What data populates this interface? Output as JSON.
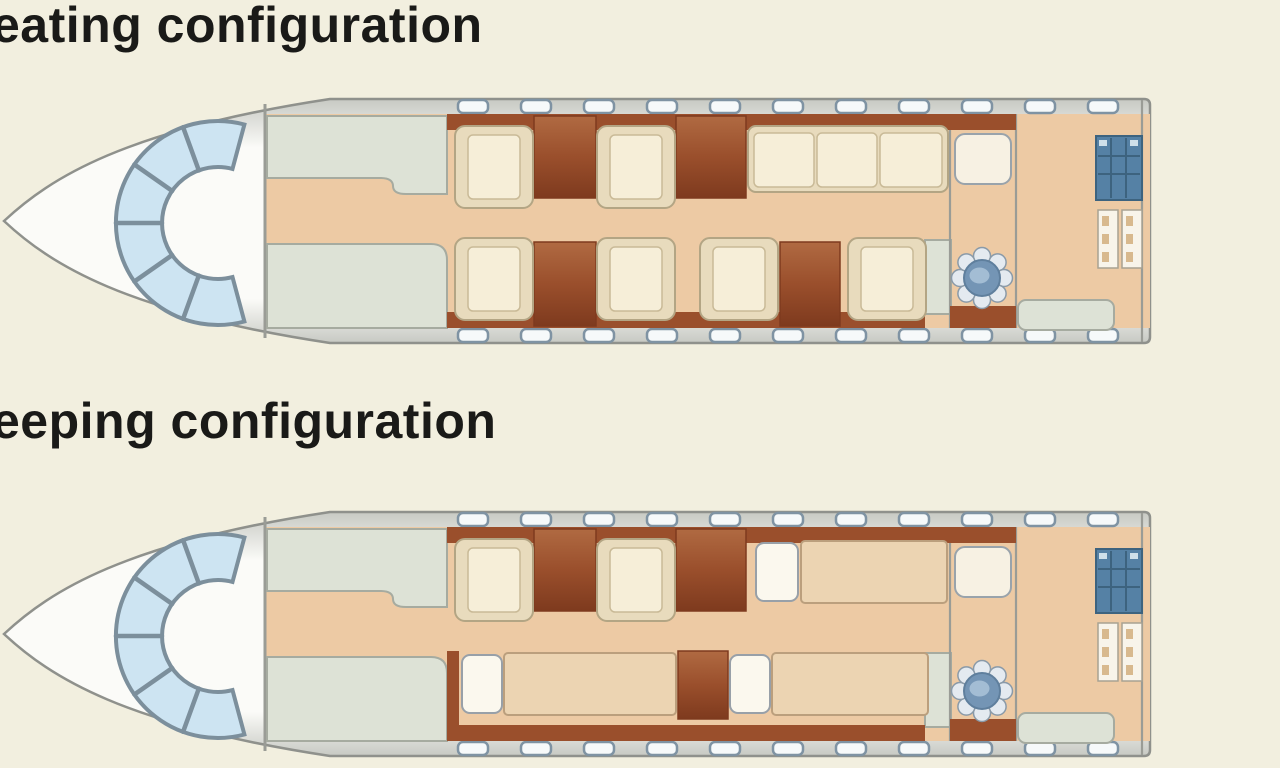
{
  "page": {
    "background": "#f2efdf"
  },
  "titles": {
    "seating": "eating configuration",
    "sleeping": "eeping configuration"
  },
  "palette": {
    "background": "#f2efdf",
    "title": "#1a1a18",
    "outline": "#8f918c",
    "hull-edge": "#c7c9c3",
    "hull-mid": "#fbfbf8",
    "wall": "#9a9c96",
    "glass": "#cde4f2",
    "glass-edge": "#7c8f9c",
    "floor": "#edcaa4",
    "sage": "#dde2d6",
    "sage-edge": "#a6aba0",
    "wood": "#9a4f2c",
    "wood-dark": "#7e3a1e",
    "wood-light": "#b06a42",
    "seat-frame": "#e8dbbd",
    "seat-edge": "#b3a584",
    "cushion": "#f6eed8",
    "cushion-edge": "#c9ba97",
    "window": "#f6f9fa",
    "window-edge": "#7f93a3",
    "vanity": "#f7f1e3",
    "vanity-edge": "#99a3ab",
    "bowl": "#7495b5",
    "bowl-edge": "#5f7f9d",
    "bowl-light": "#a3bdd4",
    "scallop": "#e4eaf0",
    "scallop-edge": "#8a9aa8",
    "teal": "#5581a5",
    "teal-dark": "#3d637f",
    "teal-light": "#cfe0ea",
    "shelf": "#f8f4ea",
    "shelf-edge": "#a8a292",
    "shelf-item": "#d8b98e",
    "mattress": "#ecd4b2",
    "mattress-edge": "#bb9f7d",
    "pillow": "#fbf8ee",
    "pillow-edge": "#98a0a8"
  },
  "diagram": {
    "aircraft_shared_features": [
      "cockpit-windshield",
      "galley",
      "wardrobe",
      "cabin-windows",
      "lavatory-vanity",
      "lavatory-toilet",
      "storage-cabinet",
      "baggage-shelves",
      "rear-bench",
      "wood-credenza"
    ],
    "seating": {
      "club_seats": 6,
      "divan_cushions": 3
    },
    "sleeping": {
      "club_seats": 2,
      "beds": 3,
      "pillows": 3
    }
  }
}
